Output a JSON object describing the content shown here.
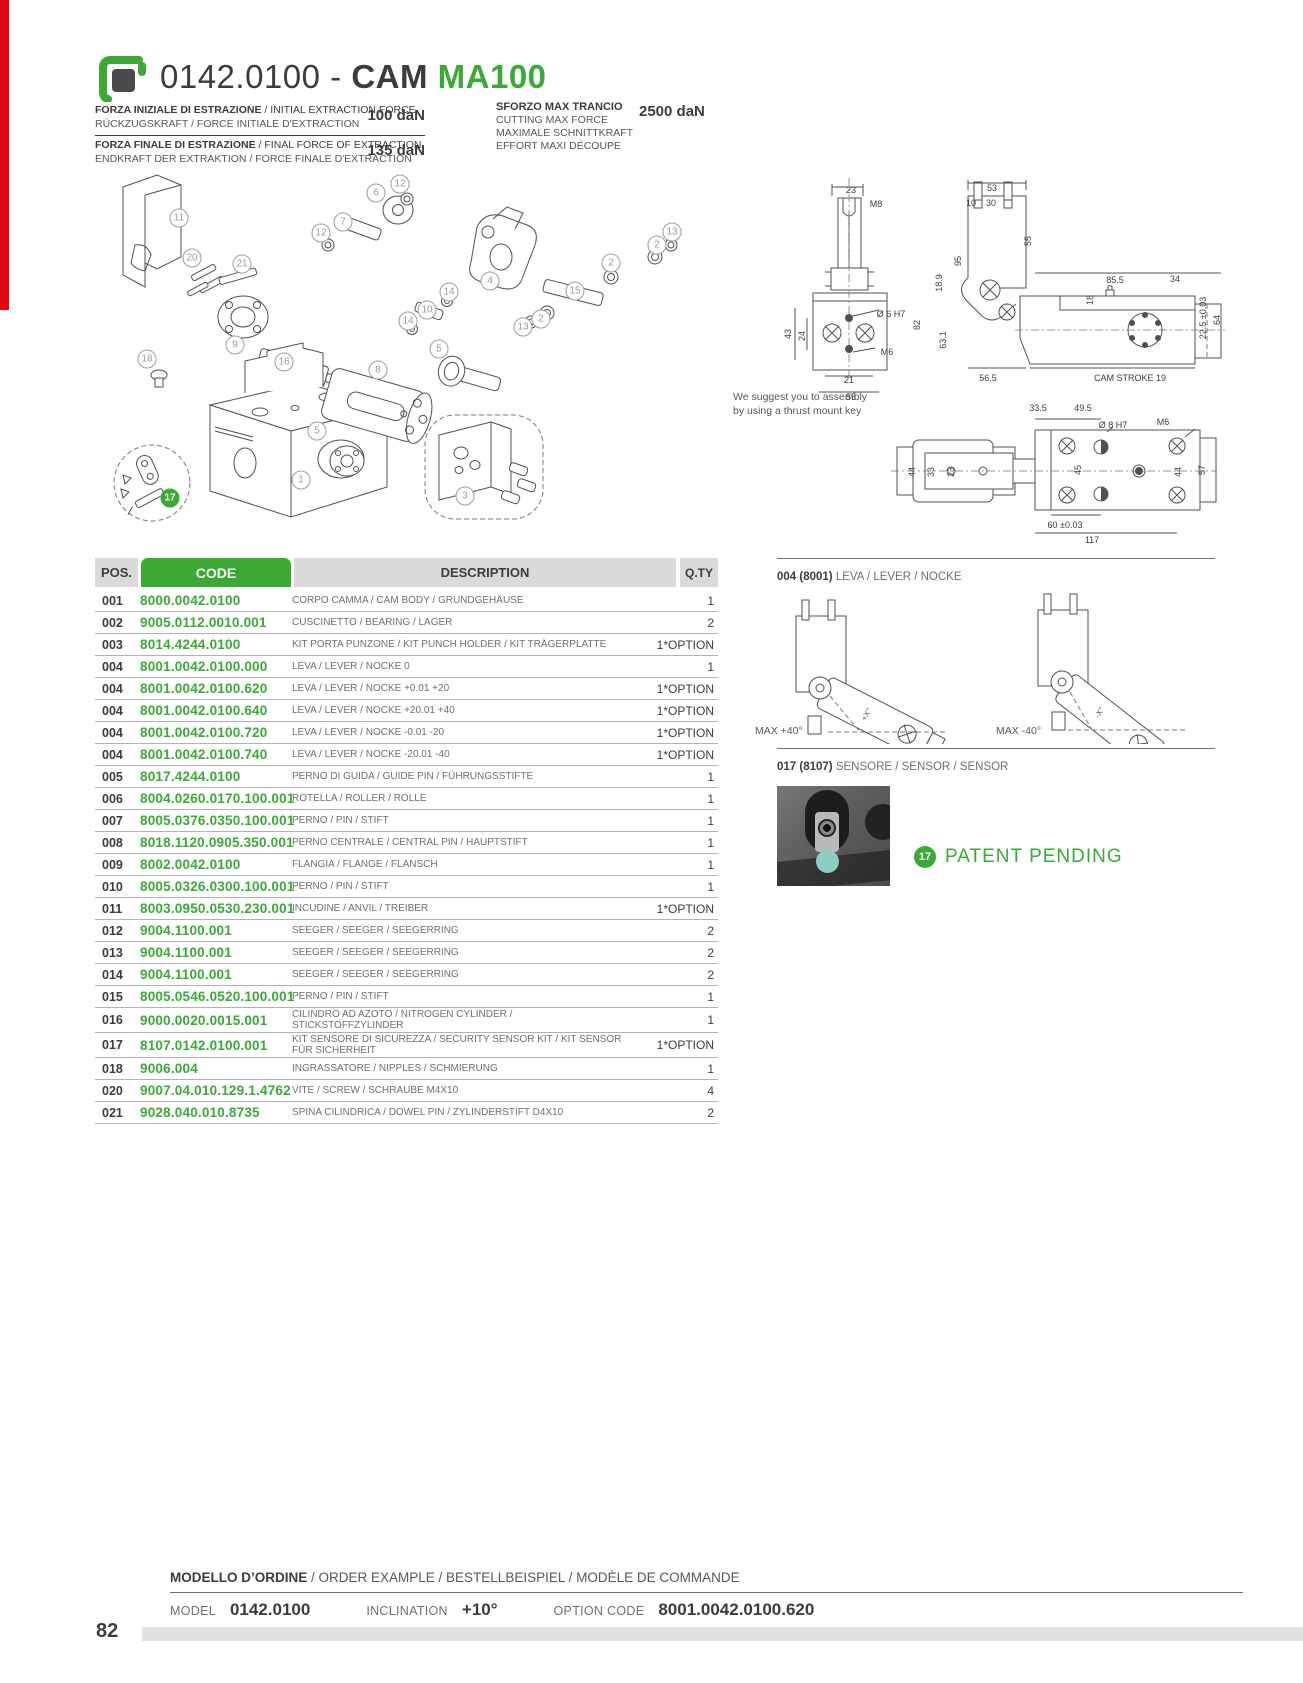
{
  "page": {
    "number": "82",
    "accent_green": "#3aaa35",
    "accent_red": "#e30613"
  },
  "header": {
    "code": "0142.0100",
    "separator": " - ",
    "name": "CAM ",
    "model": "MA100",
    "logo": "special-springs-logo"
  },
  "specs": {
    "left": [
      {
        "line1_bold": "FORZA INIZIALE DI ESTRAZIONE",
        "line1_rest": " / INITIAL EXTRACTION FORCE",
        "line2": "RÜCKZUGSKRAFT / FORCE INITIALE D'EXTRACTION",
        "value": "100 daN"
      },
      {
        "line1_bold": "FORZA FINALE DI ESTRAZIONE",
        "line1_rest": " / FINAL FORCE OF EXTRACTION",
        "line2": "ENDKRAFT DER EXTRAKTION / FORCE FINALE D'EXTRACTION",
        "value": "135 daN"
      }
    ],
    "right": {
      "title": "SFORZO MAX TRANCIO",
      "value": "2500 daN",
      "lines": [
        "CUTTING MAX FORCE",
        "MAXIMALE SCHNITTKRAFT",
        "EFFORT MAXI DÉCOUPE"
      ]
    }
  },
  "exploded": {
    "balloons": [
      {
        "n": "11",
        "x": 84,
        "y": 53
      },
      {
        "n": "6",
        "x": 281,
        "y": 28
      },
      {
        "n": "12",
        "x": 305,
        "y": 19
      },
      {
        "n": "7",
        "x": 248,
        "y": 57
      },
      {
        "n": "12",
        "x": 226,
        "y": 68
      },
      {
        "n": "20",
        "x": 97,
        "y": 93
      },
      {
        "n": "21",
        "x": 147,
        "y": 99
      },
      {
        "n": "13",
        "x": 577,
        "y": 67
      },
      {
        "n": "2",
        "x": 562,
        "y": 80
      },
      {
        "n": "4",
        "x": 395,
        "y": 116
      },
      {
        "n": "2",
        "x": 516,
        "y": 98
      },
      {
        "n": "14",
        "x": 354,
        "y": 127
      },
      {
        "n": "10",
        "x": 332,
        "y": 145
      },
      {
        "n": "15",
        "x": 480,
        "y": 126
      },
      {
        "n": "14",
        "x": 313,
        "y": 156
      },
      {
        "n": "2",
        "x": 446,
        "y": 154
      },
      {
        "n": "13",
        "x": 428,
        "y": 162
      },
      {
        "n": "9",
        "x": 140,
        "y": 180
      },
      {
        "n": "16",
        "x": 189,
        "y": 197
      },
      {
        "n": "18",
        "x": 52,
        "y": 194
      },
      {
        "n": "5",
        "x": 344,
        "y": 184
      },
      {
        "n": "8",
        "x": 283,
        "y": 205
      },
      {
        "n": "5",
        "x": 222,
        "y": 266
      },
      {
        "n": "1",
        "x": 206,
        "y": 315
      },
      {
        "n": "3",
        "x": 370,
        "y": 331
      },
      {
        "n": "17",
        "x": 75,
        "y": 333,
        "green": true
      }
    ]
  },
  "drawings": {
    "note_line1": "We suggest you to assembly",
    "note_line2": "by using a thrust mount key",
    "front_labels": [
      {
        "t": "23",
        "x": 76,
        "y": 22
      },
      {
        "t": "M8",
        "x": 101,
        "y": 36
      },
      {
        "t": "Ø 6 H7",
        "x": 116,
        "y": 146
      },
      {
        "t": "M6",
        "x": 112,
        "y": 184
      },
      {
        "t": "43",
        "x": 13,
        "y": 166,
        "r": true
      },
      {
        "t": "24",
        "x": 27,
        "y": 168,
        "r": true
      },
      {
        "t": "21",
        "x": 74,
        "y": 212
      },
      {
        "t": "55",
        "x": 76,
        "y": 229
      }
    ],
    "side_labels": [
      {
        "t": "53",
        "x": 137,
        "y": 20
      },
      {
        "t": "10",
        "x": 116,
        "y": 35
      },
      {
        "t": "30",
        "x": 136,
        "y": 35
      },
      {
        "t": "55",
        "x": 173,
        "y": 73,
        "r": true
      },
      {
        "t": "95",
        "x": 103,
        "y": 93,
        "r": true
      },
      {
        "t": "18.9",
        "x": 84,
        "y": 115,
        "r": true
      },
      {
        "t": "82",
        "x": 62,
        "y": 157,
        "r": true
      },
      {
        "t": "63.1",
        "x": 88,
        "y": 172,
        "r": true
      },
      {
        "t": "85.5",
        "x": 260,
        "y": 112
      },
      {
        "t": "34",
        "x": 320,
        "y": 111
      },
      {
        "t": "18",
        "x": 235,
        "y": 132,
        "r": true
      },
      {
        "t": "22.5 ±0.03",
        "x": 348,
        "y": 150,
        "r": true
      },
      {
        "t": "64",
        "x": 362,
        "y": 152,
        "r": true
      },
      {
        "t": "CAM STROKE 19",
        "x": 275,
        "y": 210
      },
      {
        "t": "56.5",
        "x": 133,
        "y": 210
      }
    ],
    "top_labels": [
      {
        "t": "33.5",
        "x": 183,
        "y": 23
      },
      {
        "t": "49.5",
        "x": 228,
        "y": 23
      },
      {
        "t": "Ø 8 H7",
        "x": 258,
        "y": 40
      },
      {
        "t": "M6",
        "x": 308,
        "y": 37
      },
      {
        "t": "44",
        "x": 57,
        "y": 87,
        "r": true
      },
      {
        "t": "33",
        "x": 76,
        "y": 87,
        "r": true
      },
      {
        "t": "23",
        "x": 96,
        "y": 87,
        "r": true
      },
      {
        "t": "45",
        "x": 223,
        "y": 85,
        "r": true
      },
      {
        "t": "44",
        "x": 323,
        "y": 87,
        "r": true
      },
      {
        "t": "57",
        "x": 347,
        "y": 85,
        "r": true
      },
      {
        "t": "60 ±0.03",
        "x": 210,
        "y": 140
      },
      {
        "t": "117",
        "x": 237,
        "y": 155
      }
    ]
  },
  "lever_section": {
    "pos": "004 (8001)",
    "title": " LEVA / LEVER / NOCKE",
    "left_label": "MAX +40°",
    "right_label": "MAX -40°",
    "left_angle_note": "+X°",
    "right_angle_note": "-X°"
  },
  "sensor_section": {
    "pos": "017 (8107)",
    "title": " SENSORE / SENSOR / SENSOR",
    "photo": "security-sensor-photo"
  },
  "patent": {
    "badge": "17",
    "label": "PATENT PENDING"
  },
  "table": {
    "headers": {
      "pos": "POS.",
      "code": "CODE",
      "desc": "DESCRIPTION",
      "qty": "Q.TY"
    },
    "rows": [
      {
        "pos": "001",
        "code": "8000.0042.0100",
        "desc": "CORPO CAMMA / CAM BODY / GRUNDGEHÄUSE",
        "qty": "1"
      },
      {
        "pos": "002",
        "code": "9005.0112.0010.001",
        "desc": "CUSCINETTO / BEARING / LAGER",
        "qty": "2"
      },
      {
        "pos": "003",
        "code": "8014.4244.0100",
        "desc": "KIT PORTA PUNZONE / KIT PUNCH HOLDER / KIT TRÄGERPLATTE",
        "qty": "1*OPTION"
      },
      {
        "pos": "004",
        "code": "8001.0042.0100.000",
        "desc": "LEVA / LEVER / NOCKE 0",
        "qty": "1"
      },
      {
        "pos": "004",
        "code": "8001.0042.0100.620",
        "desc": "LEVA / LEVER / NOCKE +0.01 +20",
        "qty": "1*OPTION"
      },
      {
        "pos": "004",
        "code": "8001.0042.0100.640",
        "desc": "LEVA / LEVER / NOCKE +20.01 +40",
        "qty": "1*OPTION"
      },
      {
        "pos": "004",
        "code": "8001.0042.0100.720",
        "desc": "LEVA / LEVER / NOCKE -0.01 -20",
        "qty": "1*OPTION"
      },
      {
        "pos": "004",
        "code": "8001.0042.0100.740",
        "desc": "LEVA / LEVER / NOCKE -20.01 -40",
        "qty": "1*OPTION"
      },
      {
        "pos": "005",
        "code": "8017.4244.0100",
        "desc": "PERNO DI GUIDA / GUIDE PIN / FÜHRUNGSSTIFTE",
        "qty": "1"
      },
      {
        "pos": "006",
        "code": "8004.0260.0170.100.001",
        "desc": "ROTELLA / ROLLER / ROLLE",
        "qty": "1"
      },
      {
        "pos": "007",
        "code": "8005.0376.0350.100.001",
        "desc": "PERNO / PIN / STIFT",
        "qty": "1"
      },
      {
        "pos": "008",
        "code": "8018.1120.0905.350.001",
        "desc": "PERNO CENTRALE / CENTRAL PIN / HAUPTSTIFT",
        "qty": "1"
      },
      {
        "pos": "009",
        "code": "8002.0042.0100",
        "desc": "FLANGIA / FLANGE / FLANSCH",
        "qty": "1"
      },
      {
        "pos": "010",
        "code": "8005.0326.0300.100.001",
        "desc": "PERNO / PIN / STIFT",
        "qty": "1"
      },
      {
        "pos": "011",
        "code": "8003.0950.0530.230.001",
        "desc": "INCUDINE / ANVIL / TREIBER",
        "qty": "1*OPTION"
      },
      {
        "pos": "012",
        "code": "9004.1100.001",
        "desc": "SEEGER / SEEGER / SEEGERRING",
        "qty": "2"
      },
      {
        "pos": "013",
        "code": "9004.1100.001",
        "desc": "SEEGER / SEEGER / SEEGERRING",
        "qty": "2"
      },
      {
        "pos": "014",
        "code": "9004.1100.001",
        "desc": "SEEGER / SEEGER / SEEGERRING",
        "qty": "2"
      },
      {
        "pos": "015",
        "code": "8005.0546.0520.100.001",
        "desc": "PERNO / PIN / STIFT",
        "qty": "1"
      },
      {
        "pos": "016",
        "code": "9000.0020.0015.001",
        "desc": "CILINDRO AD AZOTO / NITROGEN CYLINDER / STICKSTOFFZYLINDER",
        "qty": "1"
      },
      {
        "pos": "017",
        "code": "8107.0142.0100.001",
        "desc": "KIT SENSORE DI SICUREZZA / SECURITY SENSOR KIT / KIT SENSOR FÜR SICHERHEIT",
        "qty": "1*OPTION"
      },
      {
        "pos": "018",
        "code": "9006.004",
        "desc": "INGRASSATORE / NIPPLES / SCHMIERUNG",
        "qty": "1"
      },
      {
        "pos": "020",
        "code": "9007.04.010.129.1.4762",
        "desc": "VITE / SCREW / SCHRAUBE M4X10",
        "qty": "4"
      },
      {
        "pos": "021",
        "code": "9028.040.010.8735",
        "desc": "SPINA CILINDRICA / DOWEL PIN / ZYLINDERSTIFT D4X10",
        "qty": "2"
      }
    ]
  },
  "order": {
    "title_bold": "MODELLO D’ORDINE",
    "title_rest": " / ORDER EXAMPLE / BESTELLBEISPIEL / MODÈLE DE COMMANDE",
    "fields": [
      {
        "label": "MODEL",
        "value": "0142.0100"
      },
      {
        "label": "INCLINATION",
        "value": "+10°"
      },
      {
        "label": "OPTION CODE",
        "value": "8001.0042.0100.620"
      }
    ]
  }
}
